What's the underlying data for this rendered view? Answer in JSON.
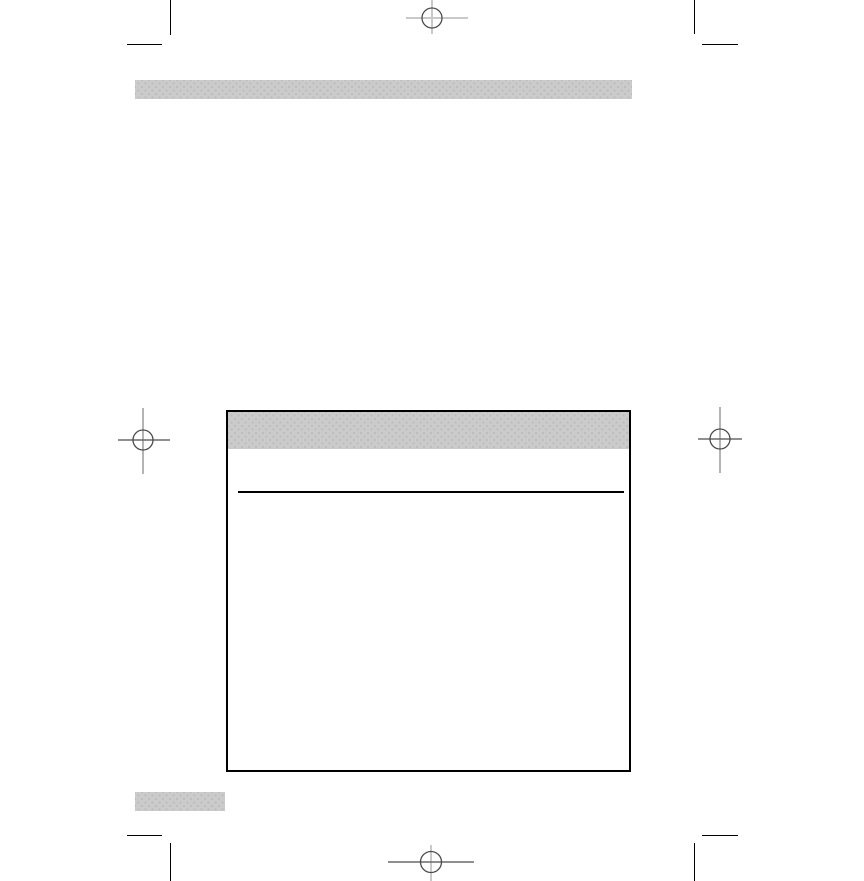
{
  "page": {
    "kind": "empty-print-proof-page",
    "visible_text": ""
  },
  "colors": {
    "page-bg": "#ffffff",
    "halftone-base": "#cbcbcb",
    "halftone-dot": "#bcbcbc",
    "crop-mark": "#000000",
    "reg-circle": "#4a4a4a",
    "reg-cross-light": "#c9c9c9",
    "reg-cross-mid": "#9a9a9a",
    "reg-cross-dark": "#6a6a6a",
    "box-border": "#000000",
    "rule": "#000000"
  },
  "icons": {
    "registration_marks": [
      "registration-mark-top-icon",
      "registration-mark-left-icon",
      "registration-mark-right-icon",
      "registration-mark-bottom-icon"
    ],
    "crop_marks": [
      "crop-mark-top-left",
      "crop-mark-top-right",
      "crop-mark-bottom-left",
      "crop-mark-bottom-right"
    ]
  },
  "blocks": {
    "top_bar": "halftone-gray-bar",
    "main_box": "outlined-box-with-gray-header-and-rule",
    "bottom_swatch": "halftone-gray-swatch"
  }
}
